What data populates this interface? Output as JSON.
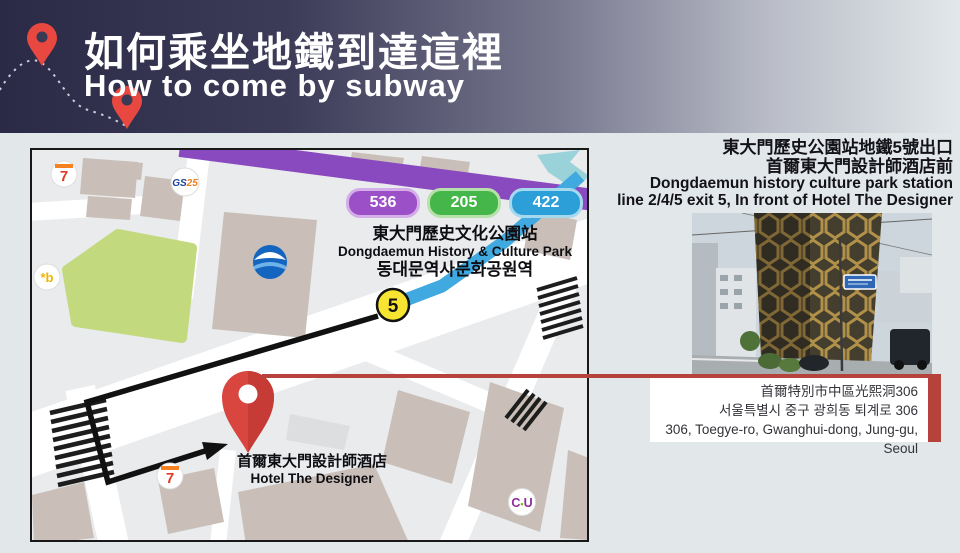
{
  "header": {
    "title_zh": "如何乘坐地鐵到達這裡",
    "title_en": "How to come by subway"
  },
  "directions": {
    "line1_zh": "東大門歷史公園站地鐵5號出口",
    "line2_zh": "首爾東大門設計師酒店前",
    "line3_en": "Dongdaemun history culture park station",
    "line4_en": "line 2/4/5 exit 5, In front of Hotel The Designer"
  },
  "map": {
    "bus_badges": [
      {
        "number": "536",
        "color": "#9c50c8"
      },
      {
        "number": "205",
        "color": "#45b649"
      },
      {
        "number": "422",
        "color": "#2d9fd8"
      }
    ],
    "station": {
      "name_zh": "東大門歷史文化公園站",
      "name_en": "Dongdaemun History & Culture Park",
      "name_ko": "동대문역사문화공원역"
    },
    "exit_number": "5",
    "hotel": {
      "name_zh": "首爾東大門設計師酒店",
      "name_en": "Hotel The Designer"
    },
    "poi": {
      "seven_eleven_top": "7",
      "seven_eleven_bottom": "7",
      "gs25_gs": "GS",
      "gs25_25": "25",
      "kb": "*b",
      "cu_c": "C",
      "cu_dot": "•",
      "cu_u": "U"
    }
  },
  "address": {
    "line_zh": "首爾特別市中區光熙洞306",
    "line_ko": "서울특별시 중구 광희동 퇴계로 306",
    "line_en": "306, Toegye-ro, Gwanghui-dong, Jung-gu, Seoul"
  },
  "colors": {
    "header_dark": "#2b2a46",
    "page_bg": "#e2e8ea",
    "pin_red": "#d9453f",
    "leader_red": "#b5433c",
    "purple_road": "#8a4abf",
    "subway_blue": "#3fa9e0",
    "park_green": "#c3d97e",
    "exit_yellow": "#f7e431",
    "building_tan": "#c9bfb8"
  }
}
